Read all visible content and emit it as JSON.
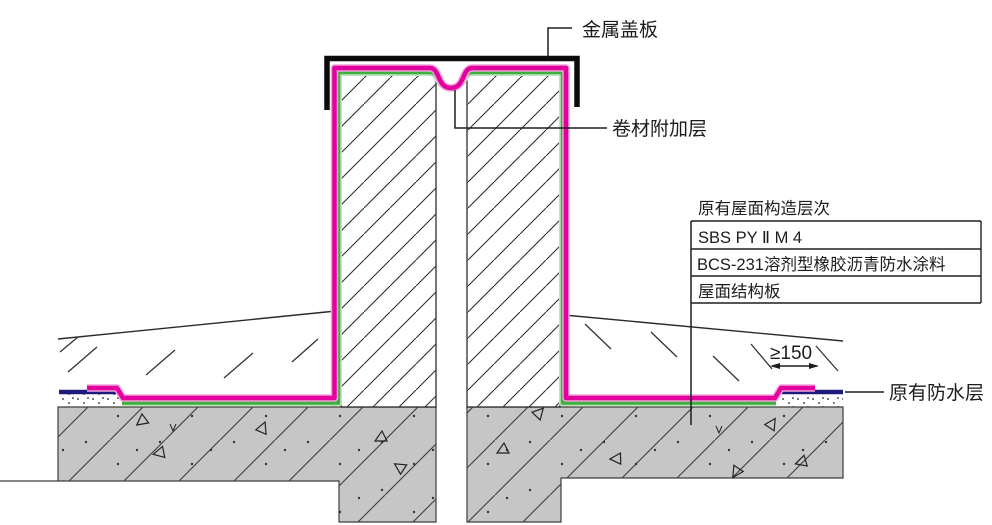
{
  "drawing": {
    "labels": {
      "metal_cover_plate": "金属盖板",
      "membrane_additional_layer": "卷材附加层",
      "existing_waterproofing": "原有防水层"
    },
    "existing_roof_table": {
      "title": "原有屋面构造层次",
      "rows": [
        "SBS PY Ⅱ M 4",
        "BCS-231溶剂型橡胶沥青防水涂料",
        "屋面结构板"
      ]
    },
    "dimension_min_lap": "≥150",
    "colors": {
      "membrane_magenta": "#e2009e",
      "membrane_halo": "#f0a3d8",
      "coating_green": "#3fae3f",
      "coating_halo": "#bfe6bb",
      "existing_waterproof_blue": "#1b1b7e",
      "cover_plate_black": "#0b0b0b",
      "concrete_gray": "#c6c6c6",
      "line_dark": "#222222"
    }
  }
}
